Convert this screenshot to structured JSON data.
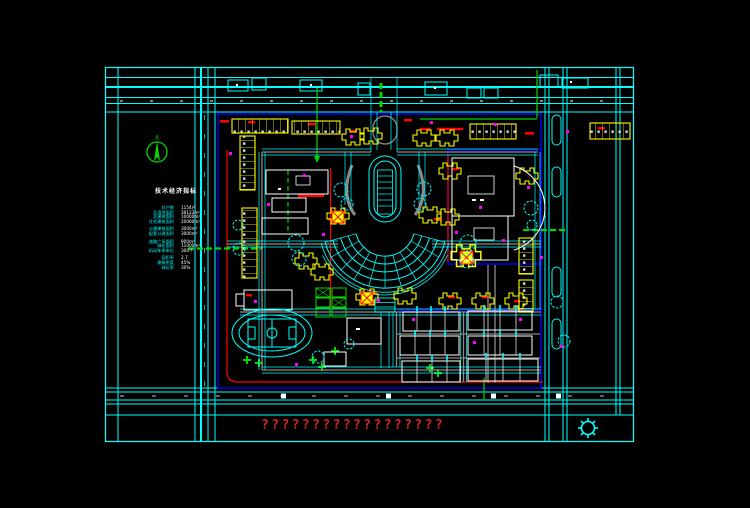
{
  "drawing_title": "residential-district-master-plan",
  "north": {
    "label": "北"
  },
  "legend": {
    "title": "技术经济指标",
    "rows": [
      {
        "label": "总户数",
        "value": "1154户"
      },
      {
        "label": "总用地面积",
        "value": "39123m²"
      },
      {
        "label": "总建筑面积",
        "value": "10000m²"
      },
      {
        "label": "住宅建筑面积",
        "value": "20000m²"
      },
      {
        "label": "公建建筑面积",
        "value": "3000m²"
      },
      {
        "label": "配套公建面积",
        "value": "3000m²"
      },
      {
        "label": "道路广场面积",
        "value": "900m²"
      },
      {
        "label": "绿化面积",
        "value": "11000m²"
      },
      {
        "label": "机动车停车位",
        "value": "300个"
      },
      {
        "label": "容积率",
        "value": "2.7"
      },
      {
        "label": "建筑密度",
        "value": "45%"
      },
      {
        "label": "绿化率",
        "value": "30%"
      }
    ]
  },
  "footer": {
    "question_marks": "??????????????????"
  },
  "colors": {
    "background": "#000000",
    "linework": "#00ffff",
    "building_outline": "#ffff00",
    "boundary_blue": "#0000ff",
    "red_line": "#ff0000",
    "green_accent": "#00d800",
    "entrance_marker": "#ff00ff",
    "road_gray": "#8a8a8a",
    "text_white": "#ffffff",
    "question_red": "#cc2626"
  }
}
